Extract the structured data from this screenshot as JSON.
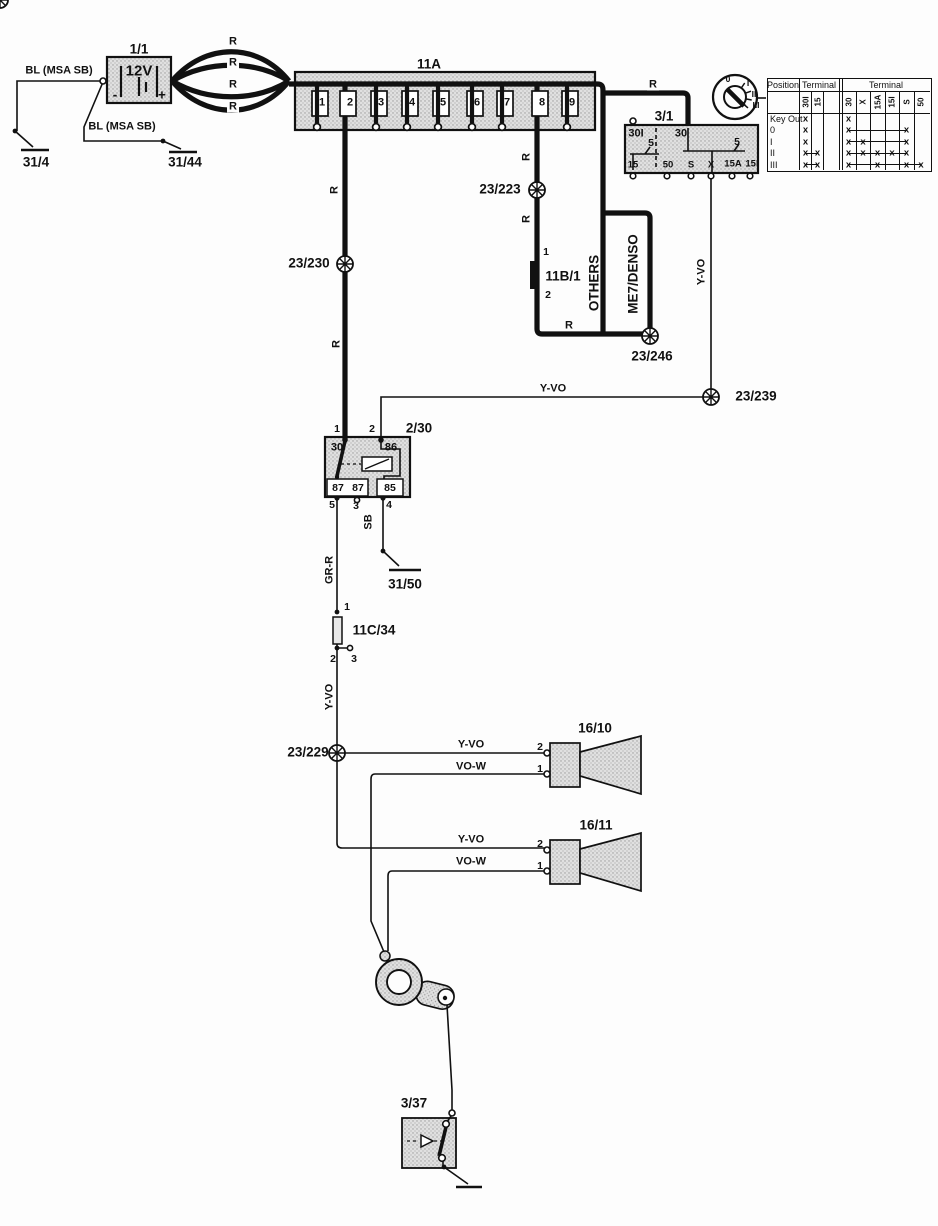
{
  "wires": {
    "bl": "BL (MSA SB)",
    "r": "R",
    "y_vo": "Y-VO",
    "vo_w": "VO-W",
    "gr_r": "GR-R",
    "sb": "SB"
  },
  "battery": {
    "id": "1/1",
    "voltage": "12V",
    "minus": "-",
    "plus": "+"
  },
  "grounds": {
    "g31_4": "31/4",
    "g31_44": "31/44",
    "g31_50": "31/50"
  },
  "fusebox": {
    "id": "11A",
    "fuses": [
      "1",
      "2",
      "3",
      "4",
      "5",
      "6",
      "7",
      "8",
      "9"
    ]
  },
  "ignition_switch": {
    "id": "3/1",
    "terminals": {
      "t30i": "30I",
      "t30": "30",
      "amp_left": "5",
      "amp_right": "5",
      "t15": "15",
      "t50": "50",
      "ts": "S",
      "tx": "X",
      "t15a": "15A",
      "t15i": "15I"
    },
    "key_positions": [
      "0",
      "I",
      "II",
      "III"
    ]
  },
  "table": {
    "header_position": "Position",
    "header_terminal_left": "Terminal",
    "header_terminal_right": "Terminal",
    "cols_left": [
      "30I",
      "15"
    ],
    "cols_right": [
      "30",
      "X",
      "15A",
      "15I",
      "S",
      "50"
    ],
    "mark": "x",
    "rows": [
      {
        "label": "Key Out",
        "left": [
          1,
          0
        ],
        "right": [
          1,
          0,
          0,
          0,
          0,
          0
        ],
        "lline": null,
        "rline": null
      },
      {
        "label": "0",
        "left": [
          1,
          0
        ],
        "right": [
          1,
          0,
          0,
          0,
          1,
          0
        ],
        "lline": null,
        "rline": [
          0,
          4
        ]
      },
      {
        "label": "I",
        "left": [
          1,
          0
        ],
        "right": [
          1,
          1,
          0,
          0,
          1,
          0
        ],
        "lline": null,
        "rline": [
          0,
          4
        ]
      },
      {
        "label": "II",
        "left": [
          1,
          1
        ],
        "right": [
          1,
          1,
          1,
          1,
          1,
          0
        ],
        "lline": [
          0,
          1
        ],
        "rline": [
          0,
          4
        ]
      },
      {
        "label": "III",
        "left": [
          1,
          1
        ],
        "right": [
          1,
          0,
          1,
          0,
          1,
          1
        ],
        "lline": [
          0,
          1
        ],
        "rline": [
          0,
          5
        ]
      }
    ]
  },
  "connectors": {
    "c23_223": "23/223",
    "c23_230": "23/230",
    "c23_246": "23/246",
    "c23_239": "23/239",
    "c23_229": "23/229"
  },
  "inline_connector": {
    "id": "11B/1",
    "pin1": "1",
    "pin2": "2"
  },
  "ecu_paths": {
    "others": "OTHERS",
    "me7_denso": "ME7/DENSO"
  },
  "relay": {
    "id": "2/30",
    "pin1": "1",
    "pin2": "2",
    "pin3": "3",
    "pin4": "4",
    "pin5": "5",
    "t30": "30",
    "t86": "86",
    "t87a": "87",
    "t87b": "87",
    "t85": "85"
  },
  "inline_fuse": {
    "id": "11C/34",
    "pin1": "1",
    "pin2": "2",
    "pin3": "3"
  },
  "horns": [
    {
      "id": "16/10",
      "pin2": "2",
      "pin1": "1"
    },
    {
      "id": "16/11",
      "pin2": "2",
      "pin1": "1"
    }
  ],
  "horn_switch": {
    "id": "3/37"
  }
}
